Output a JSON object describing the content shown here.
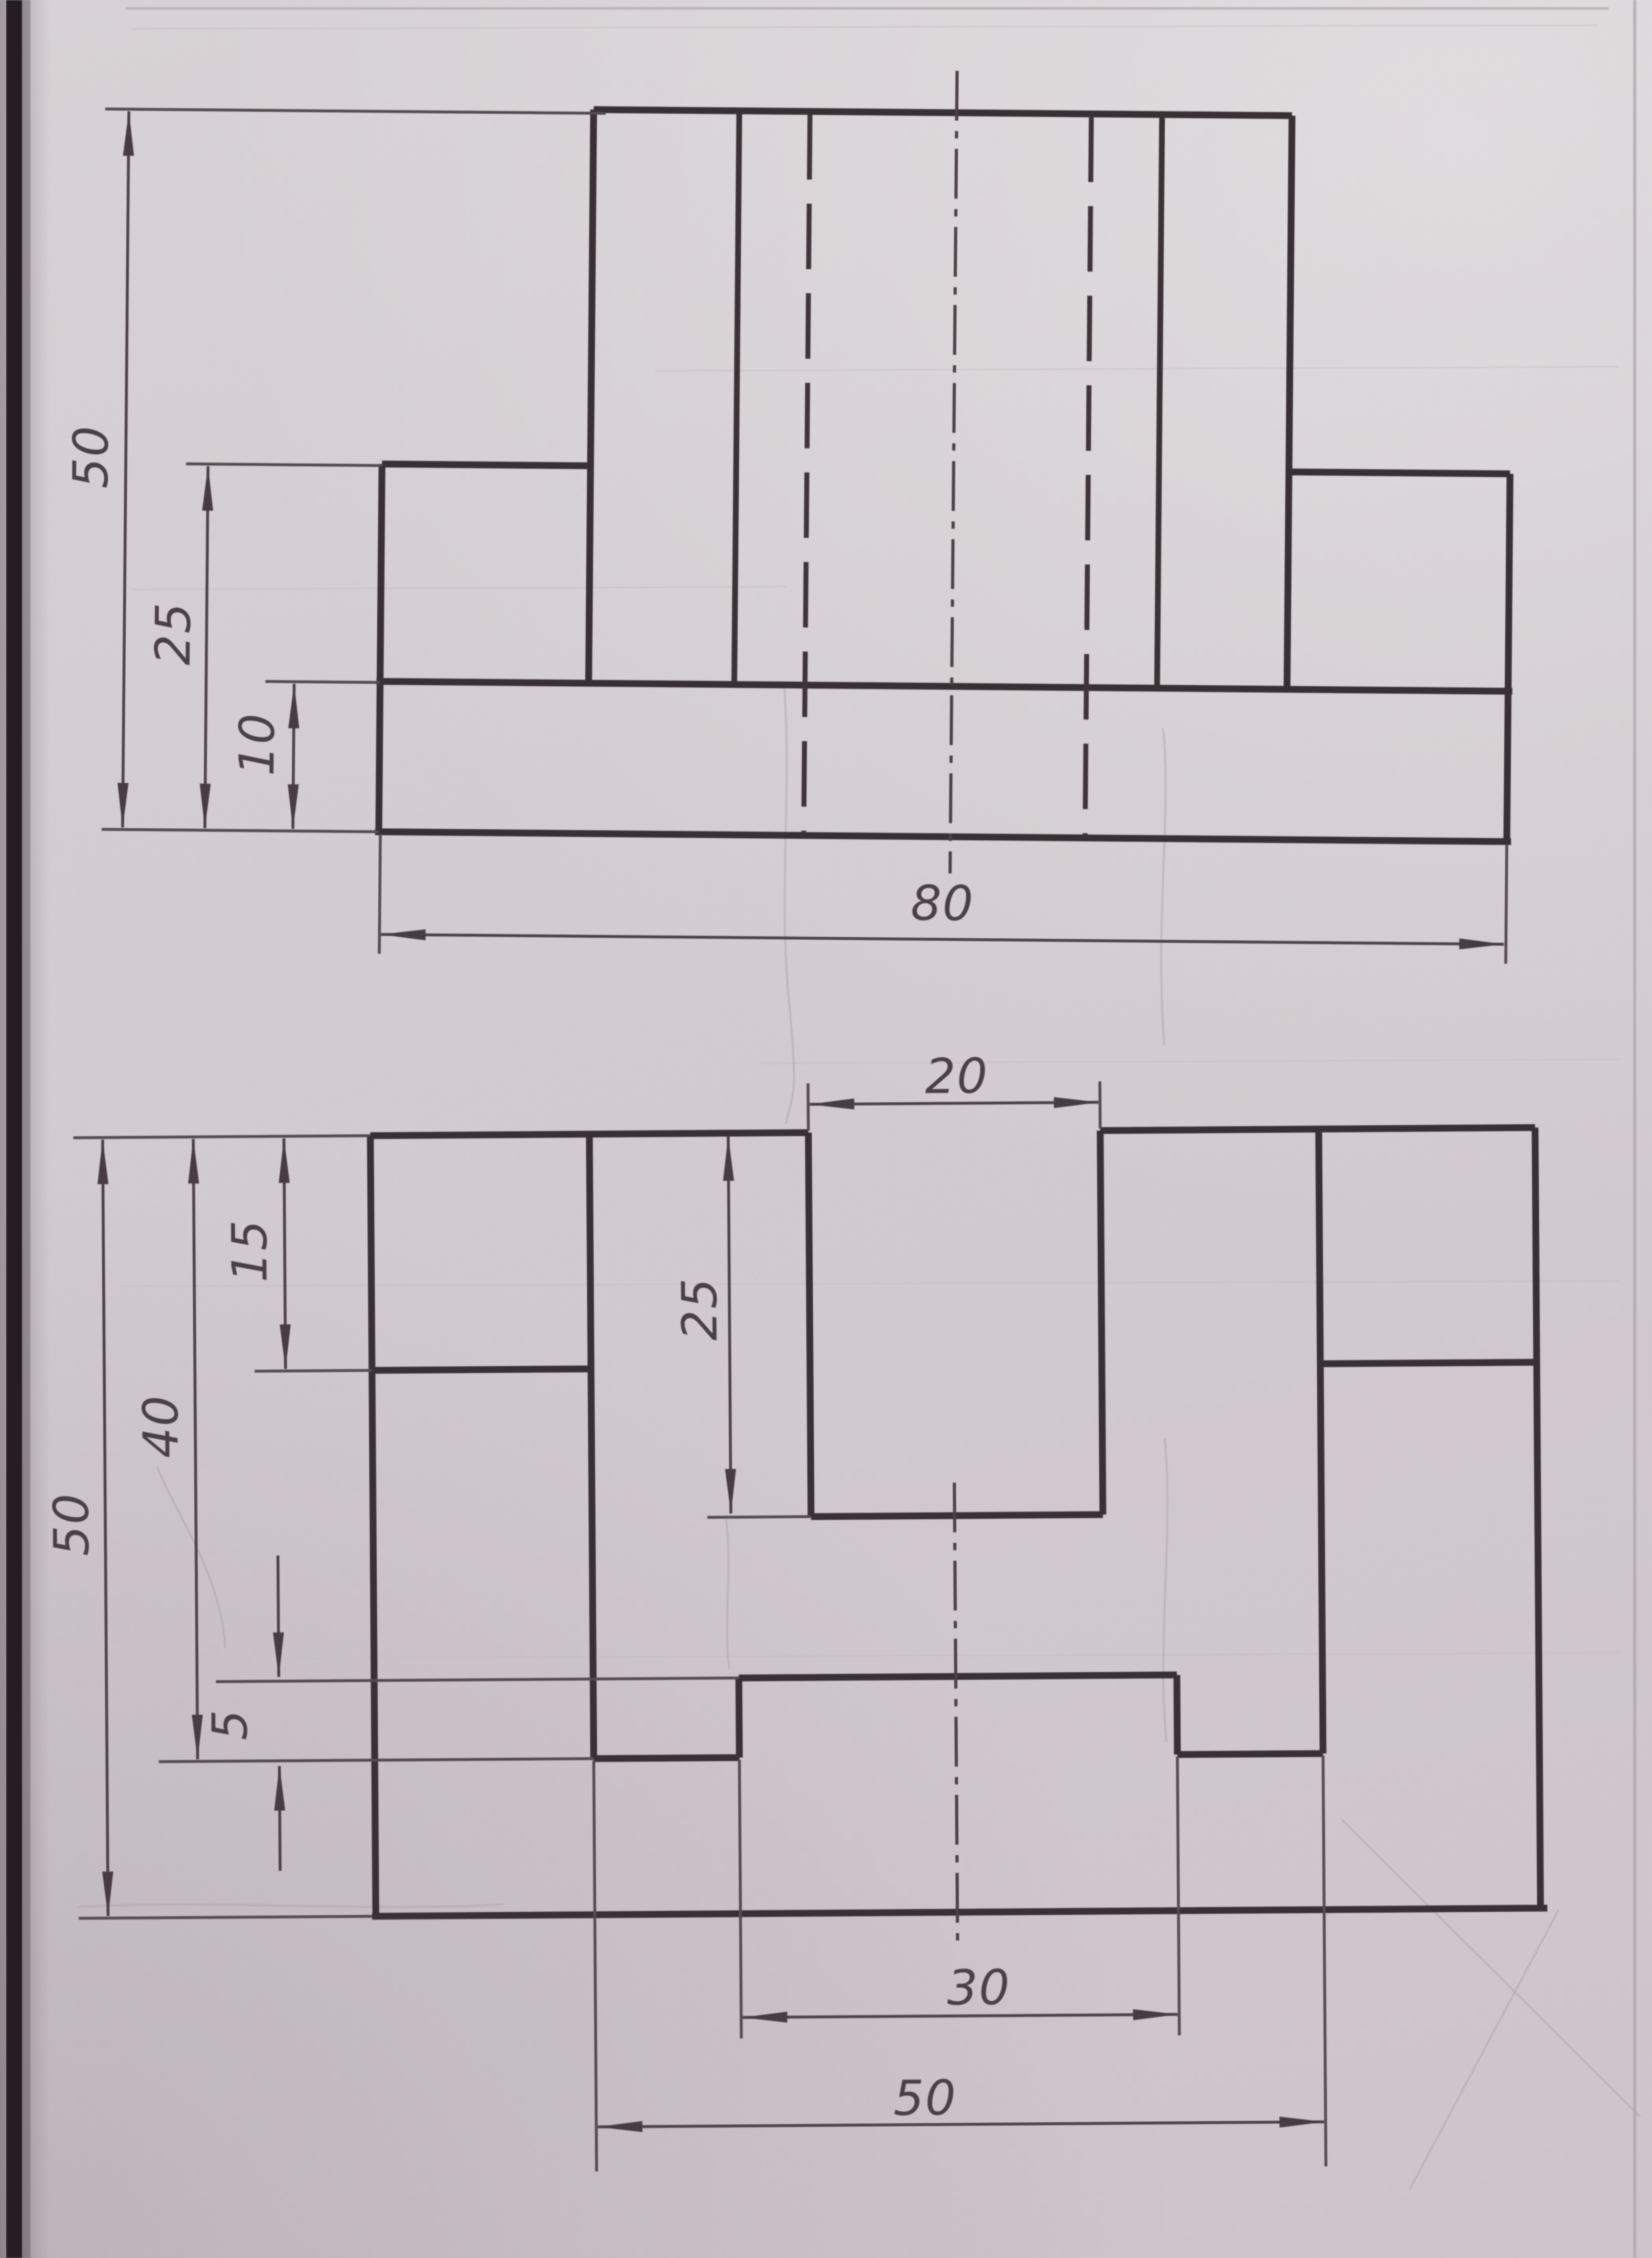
{
  "document": {
    "kind": "photographed orthographic engineering drawing, two views, ink on paper",
    "paper_color": "#d5cfd3",
    "line_color": "#383034",
    "units_shown": "none (plain numbers)"
  },
  "front_view": {
    "name": "front view (T-shaped column on base plate, hidden slot lines, vertical centerline)",
    "dims": {
      "total_height": "50",
      "shoulder_height": "25",
      "base_height": "10",
      "total_width": "80"
    }
  },
  "plan_view": {
    "name": "top view (80x50 plate, central column with 20-wide slot, corner blocks, front tab)",
    "dims": {
      "slot_width": "20",
      "slot_depth": "25",
      "block_depth": "15",
      "column_depth": "40",
      "total_depth": "50",
      "step": "5",
      "tab_width": "30",
      "column_width": "50"
    }
  }
}
